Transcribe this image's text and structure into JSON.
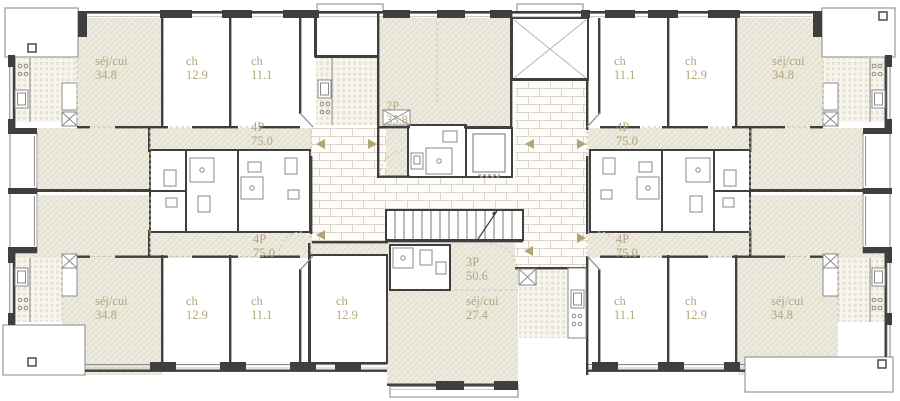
{
  "app": {
    "type": "architectural floor plan",
    "floor": "étage type"
  },
  "colors": {
    "wall": "#3f3f3f",
    "label_text": "#b3a77c",
    "arrow": "#b1a672",
    "hatch_bg": "#edeadf",
    "hatch_line": "#ddd6c2",
    "dots_bg": "#f7f5ec",
    "dots_dot": "#d8d2bc",
    "brick_bg": "#fdfcf8",
    "brick_line": "#d9d5c9"
  },
  "plan": {
    "apartments": {
      "top_left": {
        "unit": {
          "name": "4P",
          "area": "75.0"
        },
        "living": {
          "name": "séj/cui",
          "area": "34.8"
        },
        "bedroom_a": {
          "name": "ch",
          "area": "12.9"
        },
        "bedroom_b": {
          "name": "ch",
          "area": "11.1"
        }
      },
      "top_right": {
        "unit": {
          "name": "4P",
          "area": "75.0"
        },
        "living": {
          "name": "séj/cui",
          "area": "34.8"
        },
        "bedroom_a": {
          "name": "ch",
          "area": "12.9"
        },
        "bedroom_b": {
          "name": "ch",
          "area": "11.1"
        }
      },
      "bottom_left": {
        "unit": {
          "name": "4P",
          "area": "75.0"
        },
        "living": {
          "name": "séj/cui",
          "area": "34.8"
        },
        "bedroom_a": {
          "name": "ch",
          "area": "12.9"
        },
        "bedroom_b": {
          "name": "ch",
          "area": "11.1"
        }
      },
      "bottom_right": {
        "unit": {
          "name": "4P",
          "area": "75.0"
        },
        "living": {
          "name": "séj/cui",
          "area": "34.8"
        },
        "bedroom_a": {
          "name": "ch",
          "area": "12.9"
        },
        "bedroom_b": {
          "name": "ch",
          "area": "11.1"
        }
      },
      "studio_top_center": {
        "unit": {
          "name": "2P",
          "area": "35.8"
        }
      },
      "center_bottom": {
        "unit": {
          "name": "3P",
          "area": "50.6"
        },
        "living": {
          "name": "séj/cui",
          "area": "27.4"
        },
        "bedroom": {
          "name": "ch",
          "area": "12.9"
        }
      }
    }
  }
}
